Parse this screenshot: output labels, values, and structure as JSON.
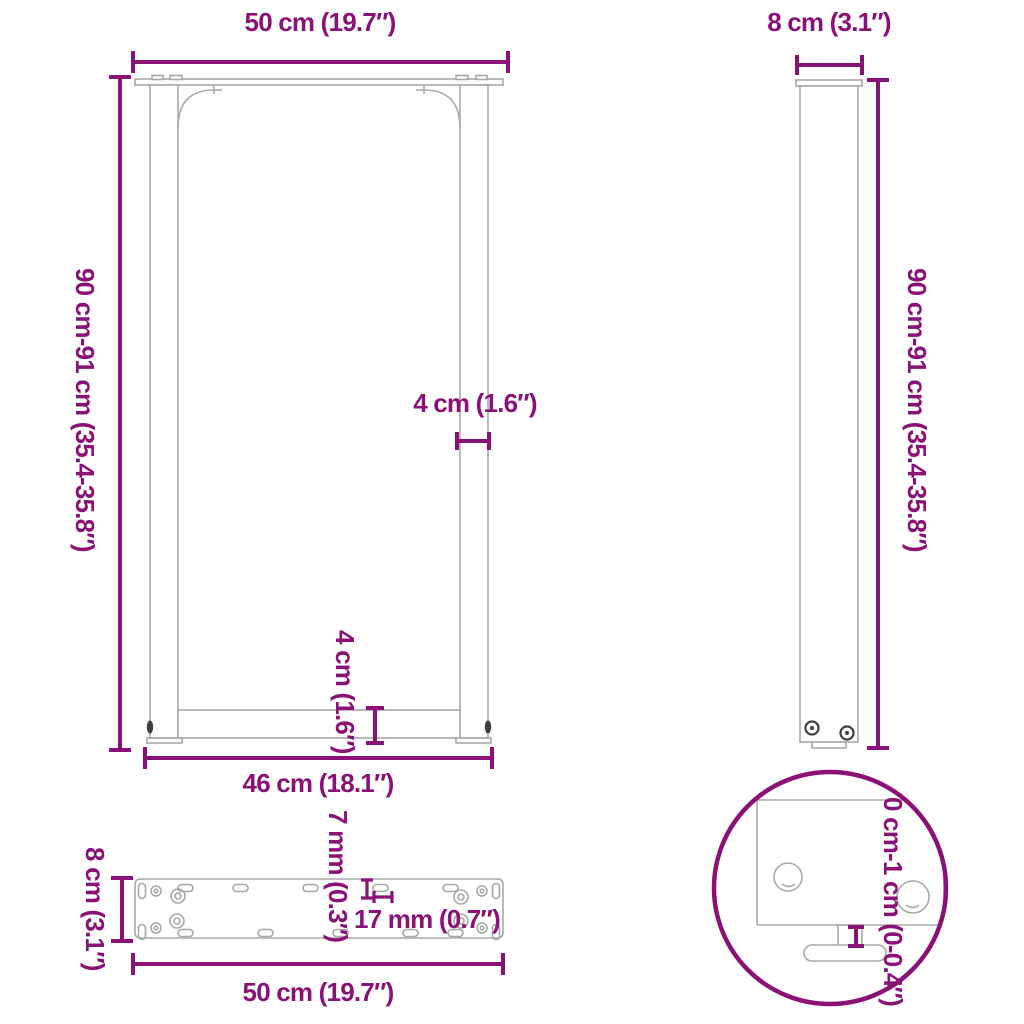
{
  "colors": {
    "accent": "#8A1277",
    "outline": "#A8A8A8",
    "dark_metal": "#3F3F3F",
    "background": "#FFFFFF"
  },
  "views": {
    "front": {
      "width_label": "50 cm (19.7″)",
      "height_label": "90 cm-91 cm (35.4-35.8″)",
      "leg_thickness_label": "4 cm (1.6″)",
      "crossbar_height_label": "4 cm (1.6″)",
      "inner_width_label": "46 cm (18.1″)"
    },
    "side": {
      "depth_label": "8 cm (3.1″)",
      "height_label": "90 cm-91 cm (35.4-35.8″)"
    },
    "mounting_plate": {
      "depth_label": "8 cm (3.1″)",
      "slot_height_label": "7 mm (0.3″)",
      "slot_length_label": "17 mm (0.7″)",
      "width_label": "50 cm (19.7″)"
    },
    "foot_detail": {
      "height_adjustment_label": "0 cm-1 cm (0-0.4″)"
    }
  }
}
